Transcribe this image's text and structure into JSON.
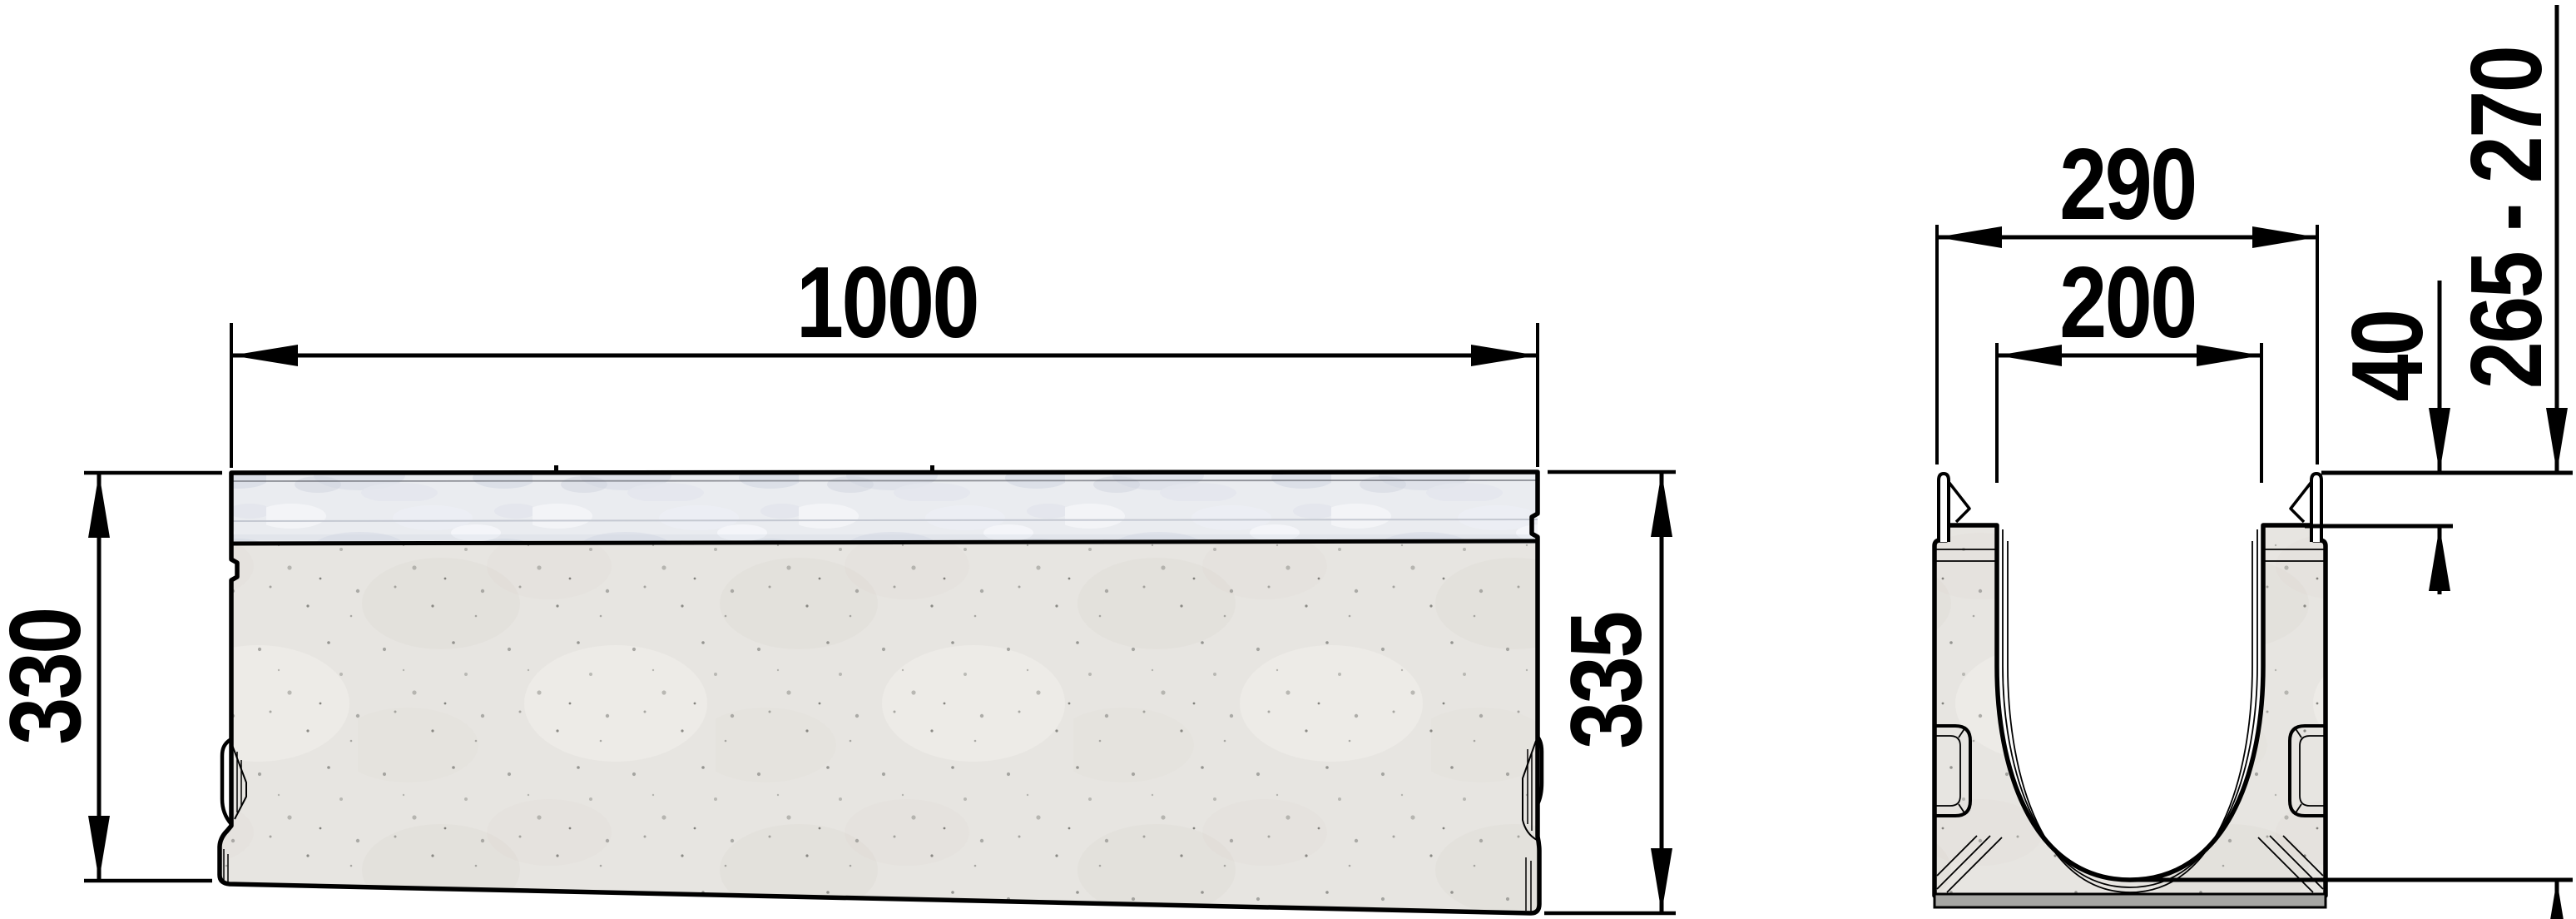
{
  "drawing": {
    "type": "technical-drawing",
    "views": {
      "elevation": "side view of drainage channel",
      "section": "cross-section of drainage channel"
    },
    "dims": {
      "length": "1000",
      "height_left": "330",
      "height_right": "335",
      "outer_width": "290",
      "inner_width": "200",
      "edge_depth": "40",
      "depth_range": "265 - 270"
    },
    "colors": {
      "line": "#000000",
      "concrete": "#e7e5e1",
      "galvanized": "#eaecf0",
      "base_strip": "#a6a6a3",
      "background": "#ffffff"
    }
  }
}
